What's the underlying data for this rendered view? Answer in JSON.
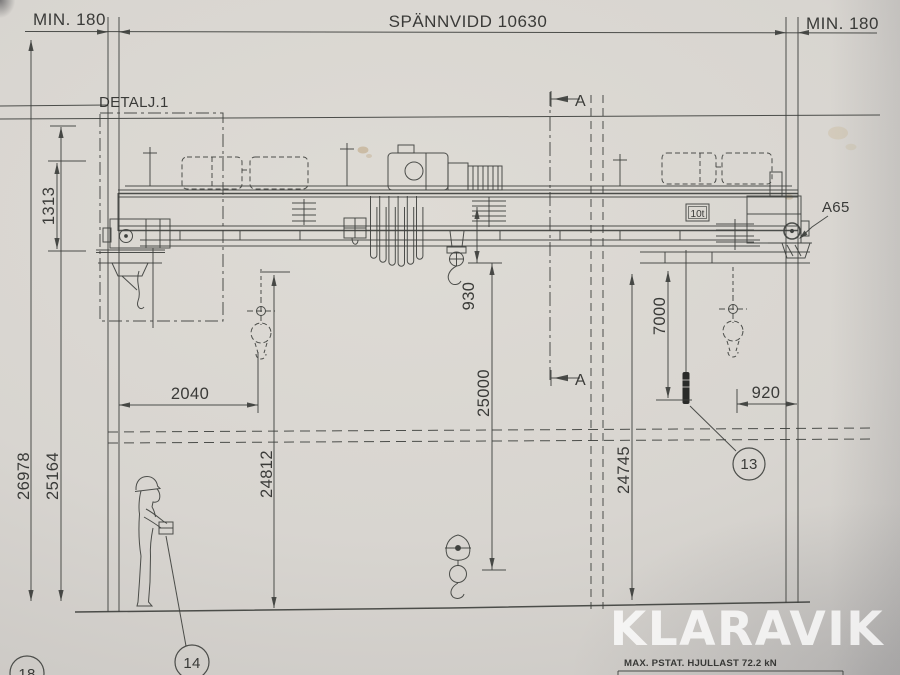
{
  "colors": {
    "paper": "#d8d5d0",
    "line": "#3f413e",
    "text": "#2d2e2c",
    "watermark": "#ffffff"
  },
  "top_dimensions": {
    "min_left": "MIN. 180",
    "span": "SPÄNNVIDD 10630",
    "min_right": "MIN. 180"
  },
  "labels": {
    "detail_1": "DETALJ.1",
    "section_a_top": "A",
    "section_a_bottom": "A",
    "a65": "A65",
    "capacity_plate": "10t"
  },
  "vertical_dimensions": {
    "d1313": "1313",
    "d26978": "26978",
    "d25164": "25164",
    "d24812": "24812",
    "d930": "930",
    "d25000": "25000",
    "d7000": "7000",
    "d24745": "24745"
  },
  "horizontal_dimensions": {
    "d2040": "2040",
    "d920": "920"
  },
  "balloons": {
    "b13": "13",
    "b14": "14",
    "b18": "18"
  },
  "footer": {
    "max_wheel_load": "MAX. PSTAT. HJULLAST 72.2 kN"
  },
  "watermark": "KLARAVIK"
}
